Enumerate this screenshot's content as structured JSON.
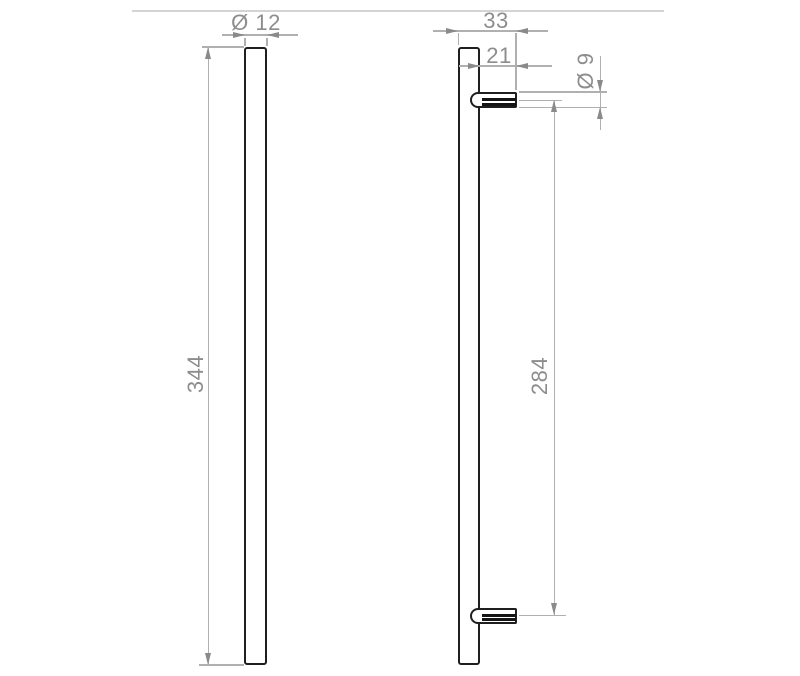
{
  "drawing": {
    "views": {
      "front": {
        "diameter_label": "Ø 12",
        "length_label": "344"
      },
      "side": {
        "overall_depth_label": "33",
        "stud_projection_label": "21",
        "stud_diameter_label": "Ø 9",
        "fixing_centres_label": "284"
      }
    },
    "colors": {
      "outline": "#1f1f1f",
      "dimension_line": "#b0b0b0",
      "dimension_text": "#8d8d8d",
      "arrow": "#8a8a8a",
      "page_rule": "#d4d4d4",
      "background": "#ffffff"
    }
  }
}
